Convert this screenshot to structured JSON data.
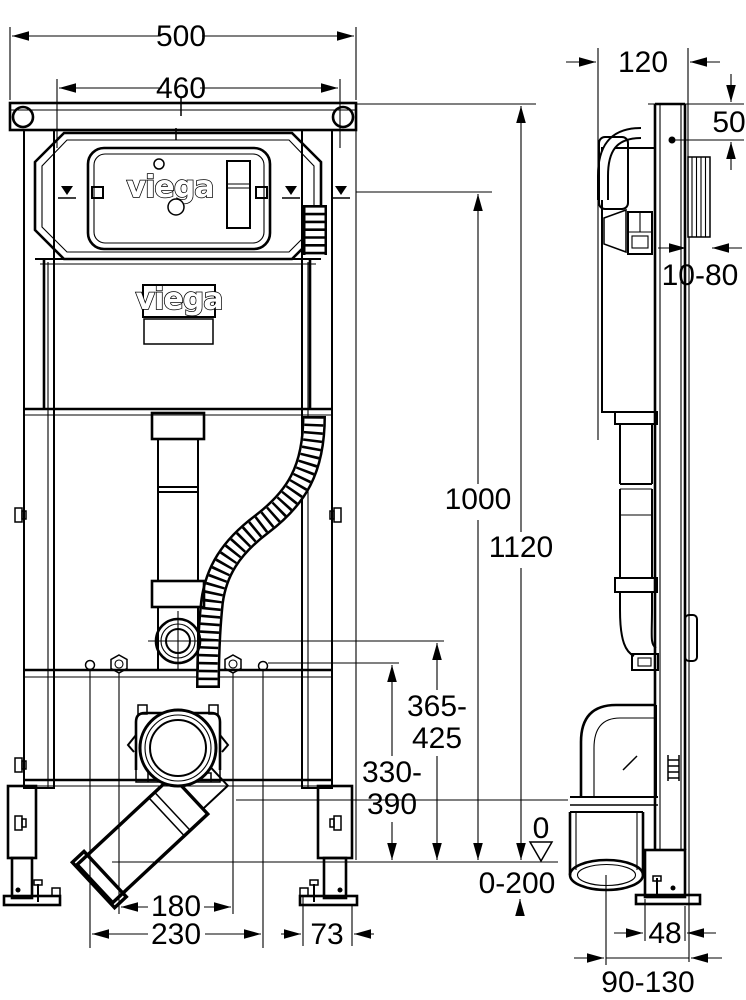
{
  "brand": {
    "flush_plate_logo": "viega",
    "cistern_label": "viega"
  },
  "dimensions": {
    "front": {
      "width_outer": "500",
      "width_inner": "460",
      "height_total": "1120",
      "height_reference": "1000",
      "supply_height_top": "365-",
      "supply_height_bottom": "425",
      "fixing_height_top": "330-",
      "fixing_height_bottom": "390",
      "floor_zero": "0",
      "floor_adjust_range": "0-200",
      "outlet_offset_inner": "180",
      "outlet_offset_outer": "230",
      "foot_depth": "73"
    },
    "side": {
      "frame_depth": "120",
      "top_fixing_offset": "50",
      "wall_thickness_range": "10-80",
      "foot_width": "48",
      "outlet_wall_distance": "90-130"
    }
  }
}
